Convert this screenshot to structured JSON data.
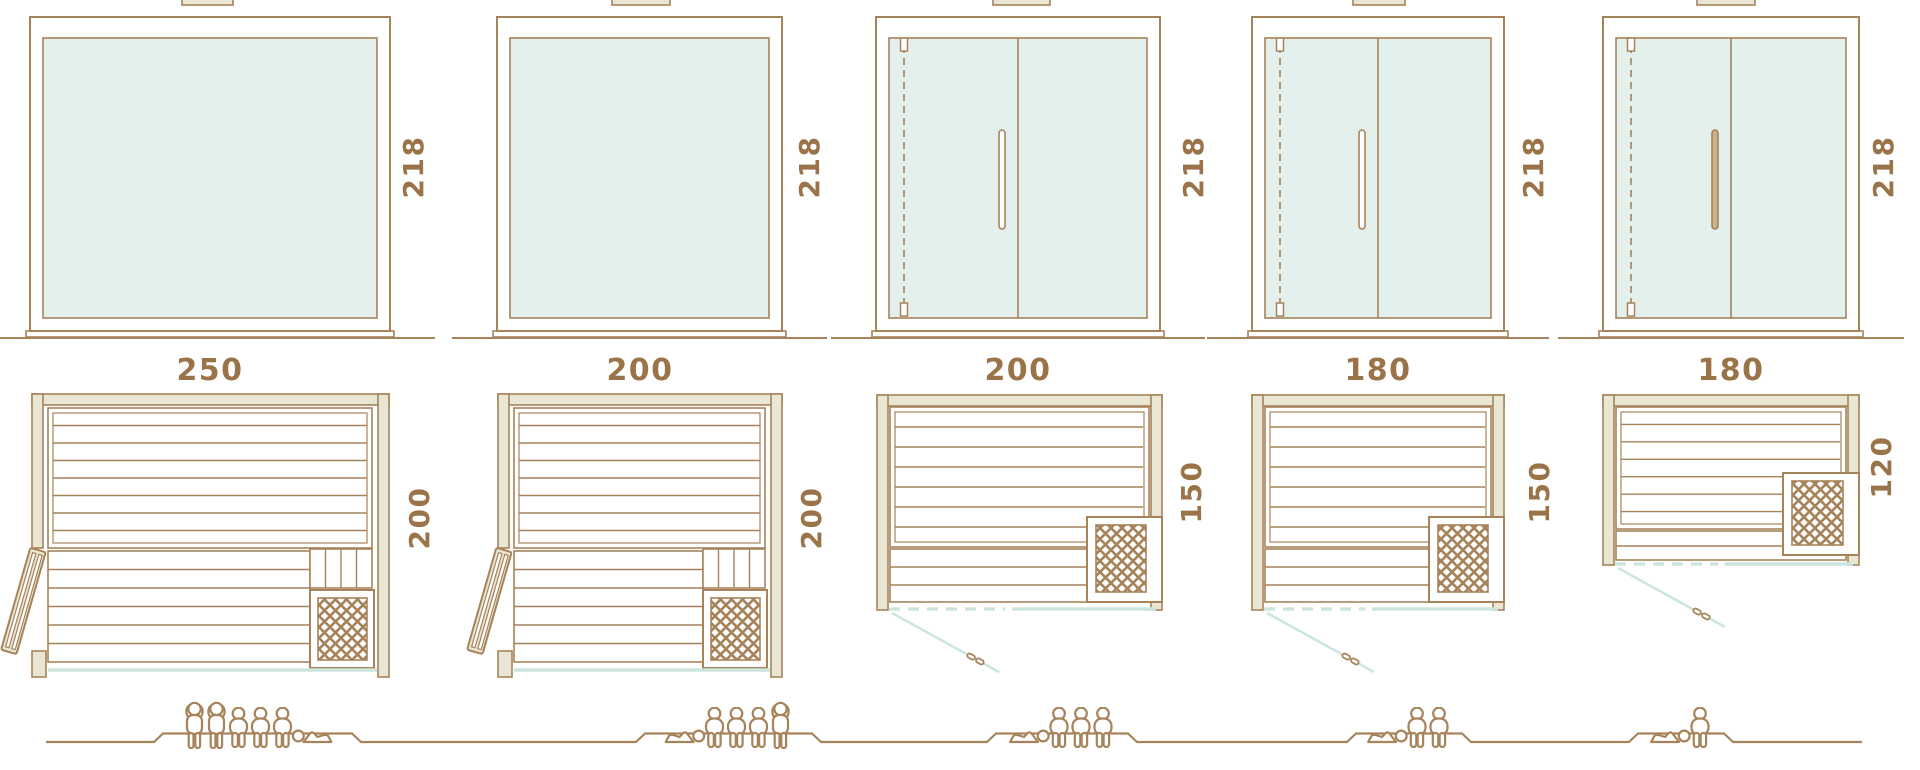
{
  "colors": {
    "line": "#a6835a",
    "text": "#9a7448",
    "wall_fill": "#e9e6d3",
    "glass_fill": "#e3f0ec",
    "accent_teal": "#cde5df",
    "handle_fill": "#c9b189",
    "background": "#ffffff"
  },
  "units": [
    {
      "width_label": "250",
      "height_label": "218",
      "depth_label": "200",
      "capacity": 6,
      "occupants": [
        "standing",
        "standing",
        "sitting",
        "sitting",
        "sitting",
        "lying-head-left"
      ]
    },
    {
      "width_label": "200",
      "height_label": "218",
      "depth_label": "200",
      "capacity": 5,
      "occupants": [
        "lying-head-right",
        "sitting",
        "sitting",
        "sitting",
        "standing"
      ]
    },
    {
      "width_label": "200",
      "height_label": "218",
      "depth_label": "150",
      "capacity": 4,
      "occupants": [
        "lying-head-right",
        "sitting",
        "sitting",
        "sitting"
      ]
    },
    {
      "width_label": "180",
      "height_label": "218",
      "depth_label": "150",
      "capacity": 3,
      "occupants": [
        "lying-head-right",
        "sitting",
        "sitting"
      ]
    },
    {
      "width_label": "180",
      "height_label": "218",
      "depth_label": "120",
      "capacity": 2,
      "occupants": [
        "lying-head-right",
        "sitting"
      ]
    }
  ]
}
